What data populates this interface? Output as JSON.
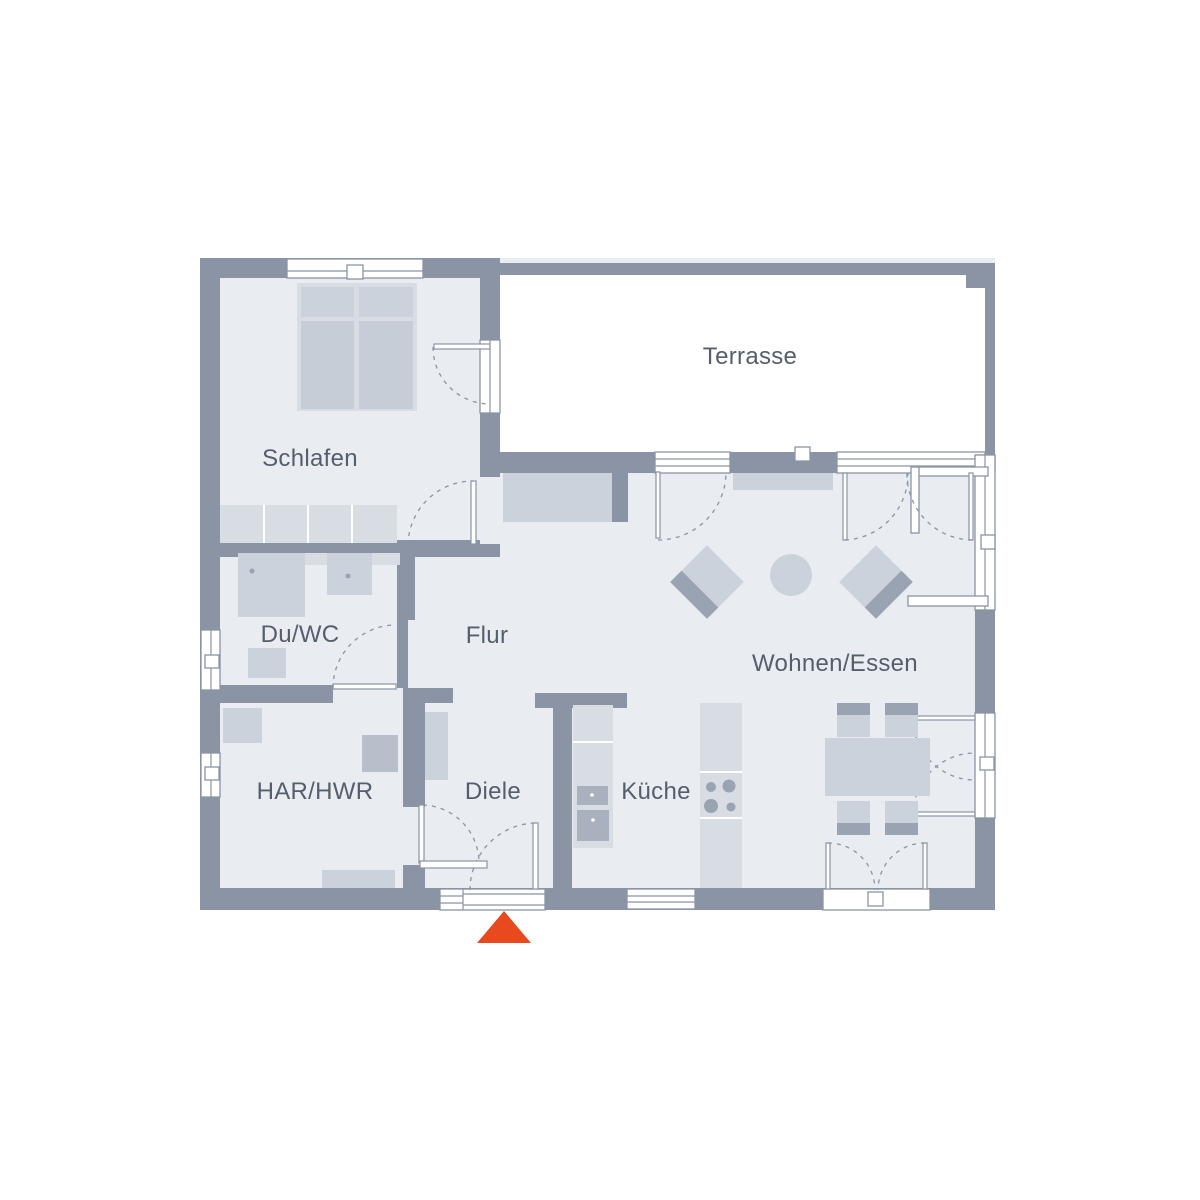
{
  "rooms": {
    "schlafen": {
      "label": "Schlafen"
    },
    "terrasse": {
      "label": "Terrasse"
    },
    "du_wc": {
      "label": "Du/WC"
    },
    "flur": {
      "label": "Flur"
    },
    "wohnen_essen": {
      "label": "Wohnen/Essen"
    },
    "har_hwr": {
      "label": "HAR/HWR"
    },
    "diele": {
      "label": "Diele"
    },
    "kueche": {
      "label": "Küche"
    }
  },
  "colors": {
    "wall": "#8a94a4",
    "floor": "#e9ecf1",
    "furniture_light": "#d8dce3",
    "furniture_mid": "#ccd2db",
    "furniture_dark": "#9aa3b1",
    "label_text": "#555e6c",
    "entrance_marker": "#e8491d"
  }
}
